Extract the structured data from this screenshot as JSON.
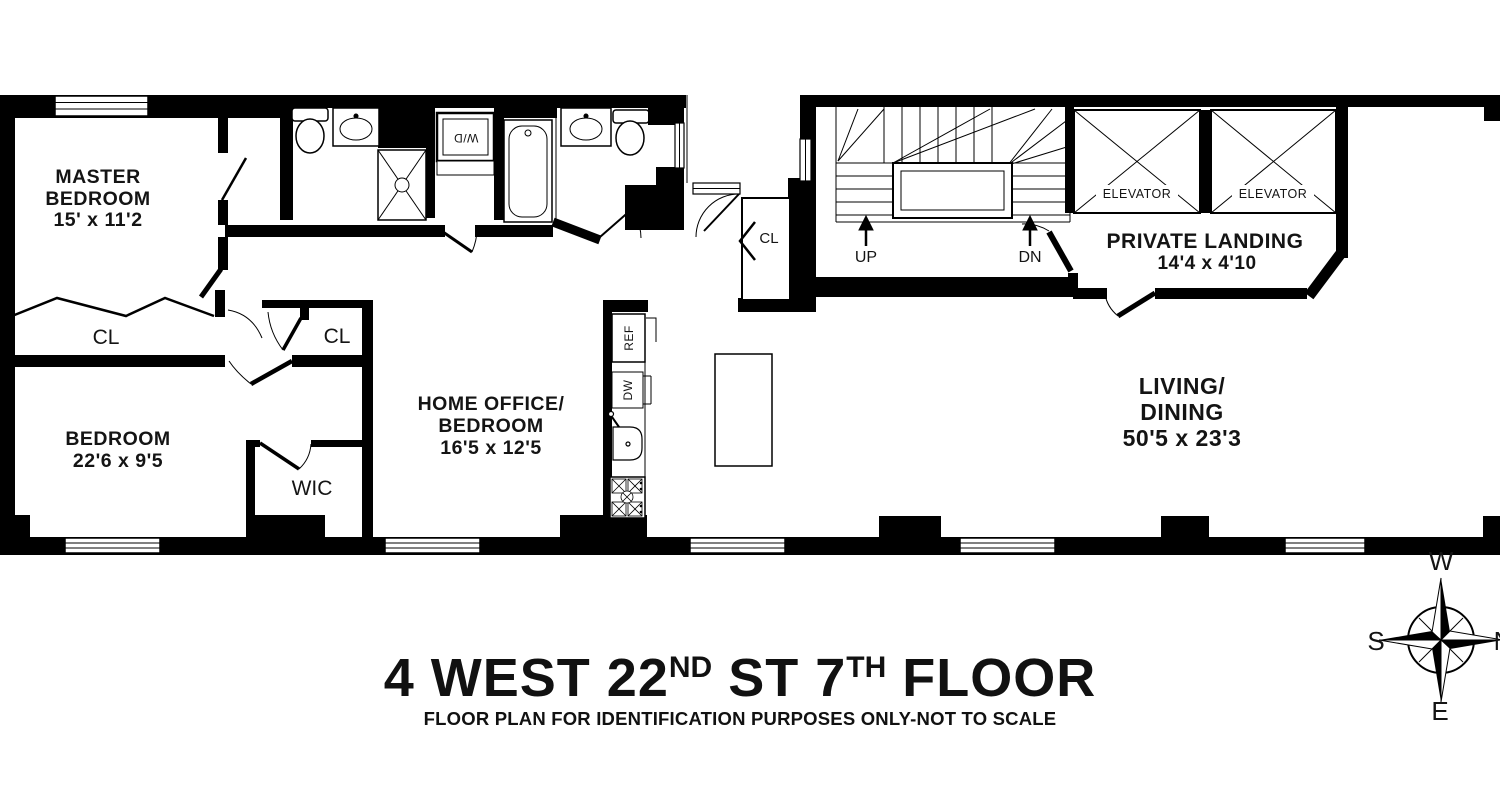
{
  "title": {
    "part1": "4 WEST 22",
    "sup1": "ND",
    "part2": " ST 7",
    "sup2": "TH",
    "part3": " FLOOR"
  },
  "subtitle": "FLOOR PLAN FOR IDENTIFICATION PURPOSES ONLY-NOT TO SCALE",
  "rooms": {
    "master_bedroom": {
      "name1": "MASTER",
      "name2": "BEDROOM",
      "dims": "15' x 11'2"
    },
    "bedroom": {
      "name1": "BEDROOM",
      "dims": "22'6 x 9'5"
    },
    "home_office": {
      "name1": "HOME OFFICE/",
      "name2": "BEDROOM",
      "dims": "16'5 x 12'5"
    },
    "living_dining": {
      "name1": "LIVING/",
      "name2": "DINING",
      "dims": "50'5 x 23'3"
    },
    "private_landing": {
      "name1": "PRIVATE LANDING",
      "dims": "14'4 x 4'10"
    },
    "wic": "WIC"
  },
  "closets": {
    "left": "CL",
    "hall": "CL",
    "entry": "CL"
  },
  "stairs": {
    "up": "UP",
    "down": "DN"
  },
  "elevators": {
    "left": "ELEVATOR",
    "right": "ELEVATOR"
  },
  "appliances": {
    "refrigerator": "REF",
    "dishwasher": "DW",
    "washer_dryer": "W/D"
  },
  "compass": {
    "west": "W",
    "south": "S",
    "east": "E",
    "north": "N"
  },
  "colors": {
    "wall": "#000000",
    "background": "#ffffff"
  }
}
